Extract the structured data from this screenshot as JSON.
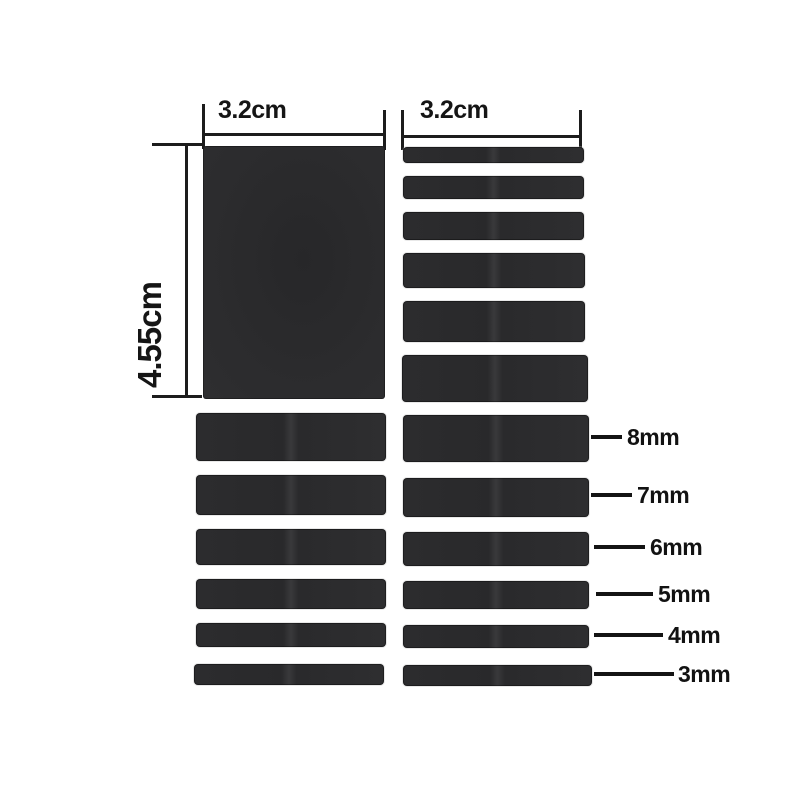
{
  "diagram": {
    "background": "#ffffff",
    "pad_color": "#2b2b2d",
    "line_color": "#1c1c1c",
    "text_color": "#151515",
    "dimensions": {
      "left_column_width": {
        "label": "3.2cm"
      },
      "right_column_width": {
        "label": "3.2cm"
      },
      "left_column_height": {
        "label": "4.55cm"
      }
    },
    "thickness_rows": [
      {
        "label": "8mm",
        "mm": 8
      },
      {
        "label": "7mm",
        "mm": 7
      },
      {
        "label": "6mm",
        "mm": 6
      },
      {
        "label": "5mm",
        "mm": 5
      },
      {
        "label": "4mm",
        "mm": 4
      },
      {
        "label": "3mm",
        "mm": 3
      }
    ],
    "strip_sets": {
      "top_right_column_mm_top_to_bottom": [
        3,
        4,
        5,
        6,
        7,
        8
      ],
      "bottom_left_column_mm_top_to_bottom": [
        8,
        7,
        6,
        5,
        4,
        3
      ],
      "bottom_right_column_mm_top_to_bottom": [
        8,
        7,
        6,
        5,
        4,
        3
      ],
      "big_pad": {
        "width_label": "3.2cm",
        "height_label": "4.55cm"
      }
    }
  }
}
